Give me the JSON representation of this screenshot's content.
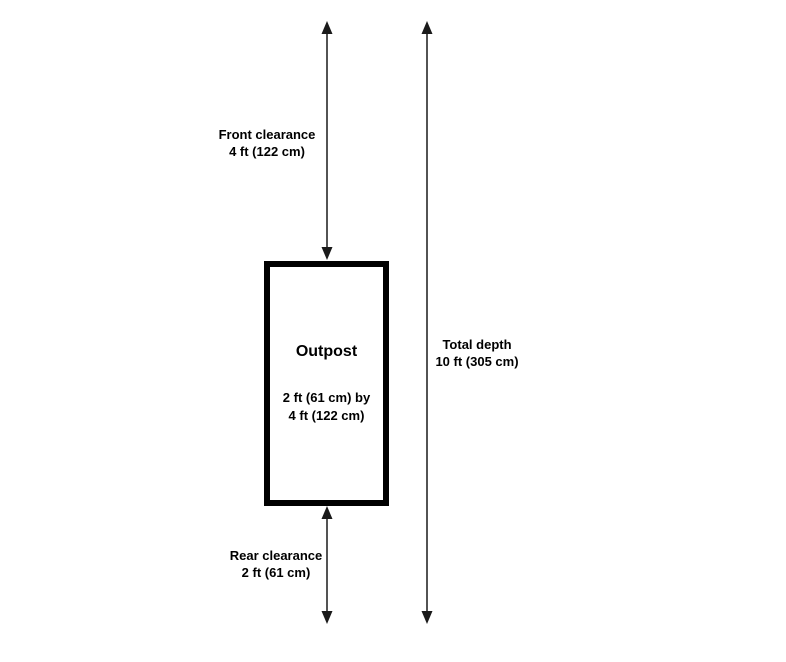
{
  "box": {
    "title": "Outpost",
    "size_line1": "2 ft (61 cm) by",
    "size_line2": "4 ft (122 cm)"
  },
  "labels": {
    "front_clearance": {
      "line1": "Front clearance",
      "line2": "4 ft (122 cm)"
    },
    "rear_clearance": {
      "line1": "Rear clearance",
      "line2": "2 ft (61 cm)"
    },
    "total_depth": {
      "line1": "Total depth",
      "line2": "10 ft (305 cm)"
    }
  },
  "colors": {
    "arrow": "#1a1a1a",
    "box_border": "#000000",
    "text": "#000000",
    "background": "#ffffff"
  }
}
